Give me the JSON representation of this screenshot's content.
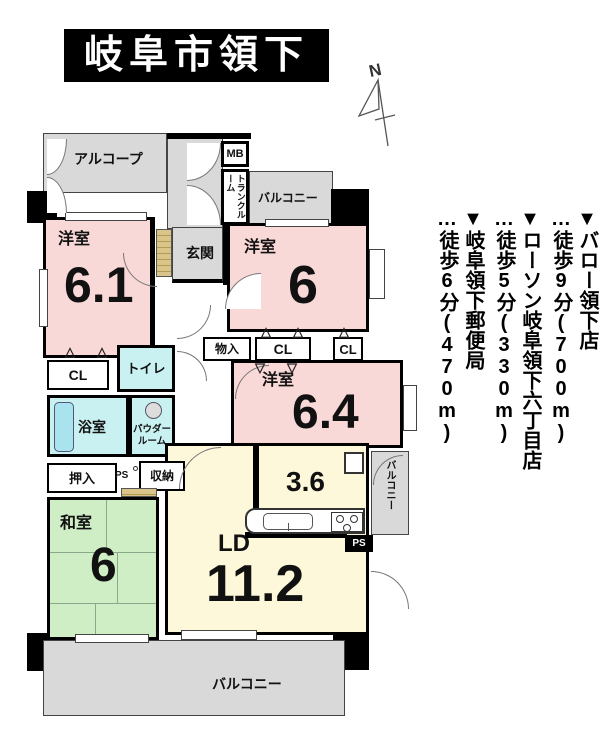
{
  "title": "岐阜市領下",
  "compass": {
    "label": "N"
  },
  "landmarks": [
    {
      "name": "▼バロー領下店",
      "walk": "…徒歩9分(700m)"
    },
    {
      "name": "▼ローソン岐阜領下六丁目店",
      "walk": "…徒歩5分(330m)"
    },
    {
      "name": "▼岐阜領下郵便局",
      "walk": "…徒歩6分(470m)"
    }
  ],
  "plan": {
    "alcove": "アルコープ",
    "mb": "MB",
    "trunk": "トランクルーム",
    "balcony_top": "バルコニー",
    "bedroom1": {
      "label": "洋室",
      "size": "6.1"
    },
    "genkan": "玄関",
    "bedroom2": {
      "label": "洋室",
      "size": "6"
    },
    "monoire": "物入",
    "cl_center": "CL",
    "cl_right": "CL",
    "bedroom3": {
      "label": "洋室",
      "size": "6.4"
    },
    "cl_left": "CL",
    "toilet": "トイレ",
    "bath": "浴室",
    "powder": "パウダー\nルーム",
    "oshiire": "押入",
    "ps_left": "PS",
    "shuunou": "収納",
    "washitsu": {
      "label": "和室",
      "size": "6"
    },
    "ld": {
      "label": "LD",
      "size": "11.2"
    },
    "kitchen_size": "3.6",
    "ps_right": "PS",
    "balcony_right": "バルコニー",
    "balcony_bottom": "バルコニー"
  },
  "marks": {
    "pair_up": "△△",
    "pair_down": "▽▽",
    "single_up": "△"
  },
  "colors": {
    "room_pink": "#f9d8d8",
    "tatami_green": "#cfeec6",
    "ld_yellow": "#fdf8d9",
    "wet_area_cyan": "#c9f1f1",
    "balcony_gray": "#d9d9d9",
    "genkan_tan": "#d9c48a",
    "wall_black": "#000000"
  }
}
